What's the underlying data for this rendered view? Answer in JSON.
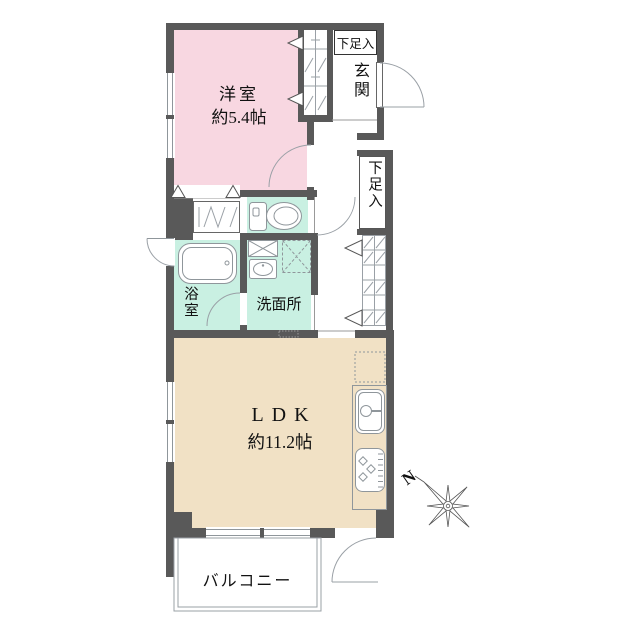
{
  "title": "マンション間取り図",
  "colors": {
    "room_pink": "#f8d7e1",
    "room_mint": "#c9f0e2",
    "room_beige": "#f1e1c5",
    "wall": "#595959",
    "line": "#8f969b"
  },
  "rooms": {
    "western_room": {
      "label": "洋室",
      "size": "約5.4帖"
    },
    "entrance": {
      "label": "玄関"
    },
    "shoe_cabinet_top": {
      "label": "下足入"
    },
    "shoe_cabinet_side": {
      "label": "下足入"
    },
    "bathroom": {
      "label": "浴室"
    },
    "washroom": {
      "label": "洗面所"
    },
    "ldk": {
      "label": "LDK",
      "size": "約11.2帖"
    },
    "balcony": {
      "label": "バルコニー"
    }
  },
  "compass": {
    "north": "N"
  },
  "fixtures": [
    "bathtub",
    "toilet",
    "vanity-sink",
    "washer-space",
    "kitchen-sink",
    "stove",
    "refrigerator-space"
  ]
}
